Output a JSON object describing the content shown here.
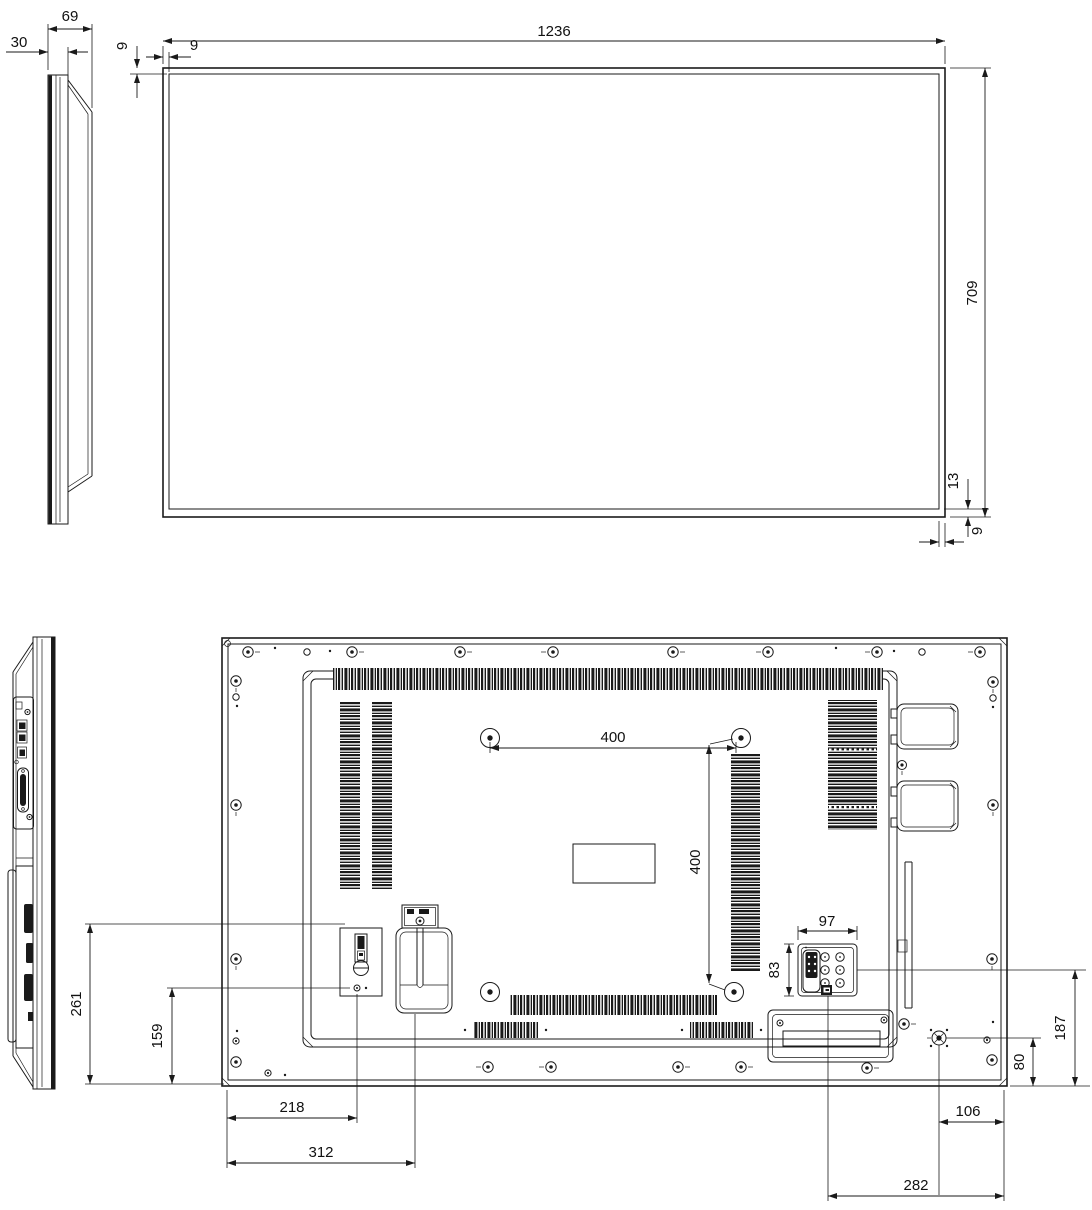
{
  "drawing": {
    "background": "#ffffff",
    "line_color": "#1a1a1a",
    "text_color": "#111111",
    "dimensions": {
      "side_front_depth": "30",
      "side_total_depth": "69",
      "front_bezel_top": "9",
      "front_bezel_left": "9",
      "front_width": "1236",
      "front_height": "709",
      "front_bezel_bottom": "13",
      "front_bezel_right": "9",
      "rear_switch_top_height": "261",
      "rear_switch_screw_height": "159",
      "vesa_width": "400",
      "vesa_height": "400",
      "keypad_width": "97",
      "keypad_height": "83",
      "switch_offset_x": "218",
      "bracket_offset_x": "312",
      "connector_offset_x": "282",
      "ground_stud_offset_x": "106",
      "ground_stud_offset_y": "80",
      "keypad_offset_y": "187"
    }
  }
}
